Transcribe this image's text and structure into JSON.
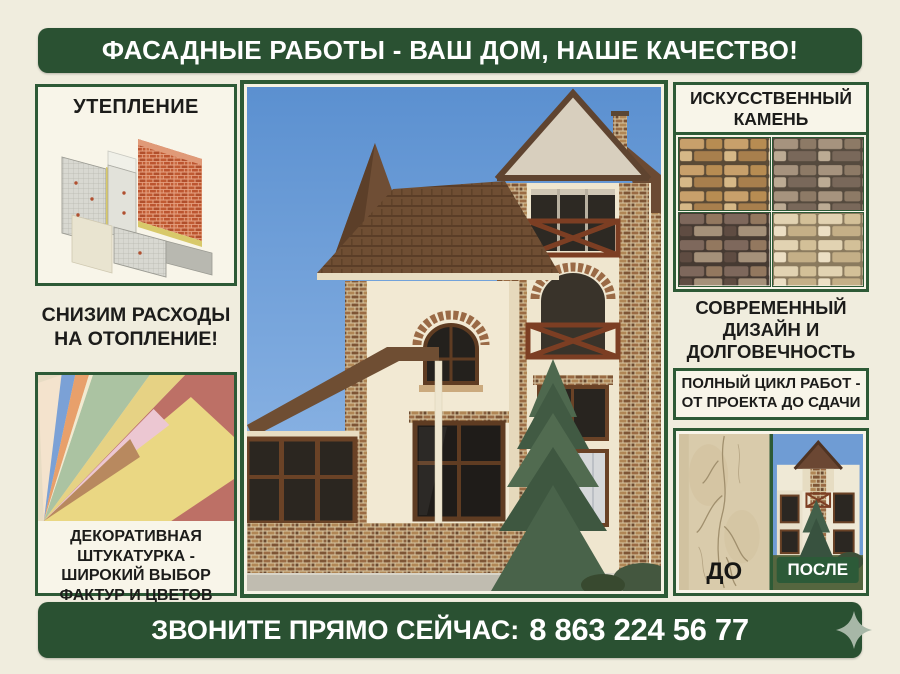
{
  "colors": {
    "background": "#f0edde",
    "banner_green": "#2a5132",
    "border_green": "#2d5a36",
    "text_dark": "#1c1c1a",
    "badge_green": "#2c5a38",
    "sparkle_gray_green": "#a7b7a7"
  },
  "top_banner": {
    "text": "ФАСАДНЫЕ РАБОТЫ - ВАШ ДОМ, НАШЕ КАЧЕСТВО!"
  },
  "left_column": {
    "insulation_box": {
      "title": "УТЕПЛЕНИЕ",
      "image": "wall-insulation-layers-diagram"
    },
    "savings_text": "СНИЗИМ РАСХОДЫ НА ОТОПЛЕНИЕ!",
    "plaster_box": {
      "caption": "ДЕКОРАТИВНАЯ ШТУКАТУРКА - ШИРОКИЙ ВЫБОР ФАКТУР И ЦВЕТОВ",
      "image": "decorative-plaster-color-fan"
    }
  },
  "center": {
    "image": "three-story-house-facade-photo"
  },
  "right_column": {
    "stone_box": {
      "title": "ИСКУССТВЕННЫЙ КАМЕНЬ",
      "images": [
        "stone-sample-tan",
        "stone-sample-gray-brown",
        "stone-sample-dark-brown",
        "stone-sample-cream"
      ]
    },
    "design_text": "СОВРЕМЕННЫЙ ДИЗАЙН И ДОЛГОВЕЧНОСТЬ",
    "cycle_box_text": "ПОЛНЫЙ ЦИКЛ РАБОТ - ОТ ПРОЕКТА ДО СДАЧИ",
    "before_after": {
      "before_label": "ДО",
      "after_label": "ПОСЛЕ",
      "before_image": "cracked-plaster-wall-photo",
      "after_image": "renovated-house-photo"
    }
  },
  "bottom_banner": {
    "call_text": "ЗВОНИТЕ ПРЯМО СЕЙЧАС:",
    "phone": "8 863 224 56 77",
    "icon": "sparkle-icon"
  }
}
